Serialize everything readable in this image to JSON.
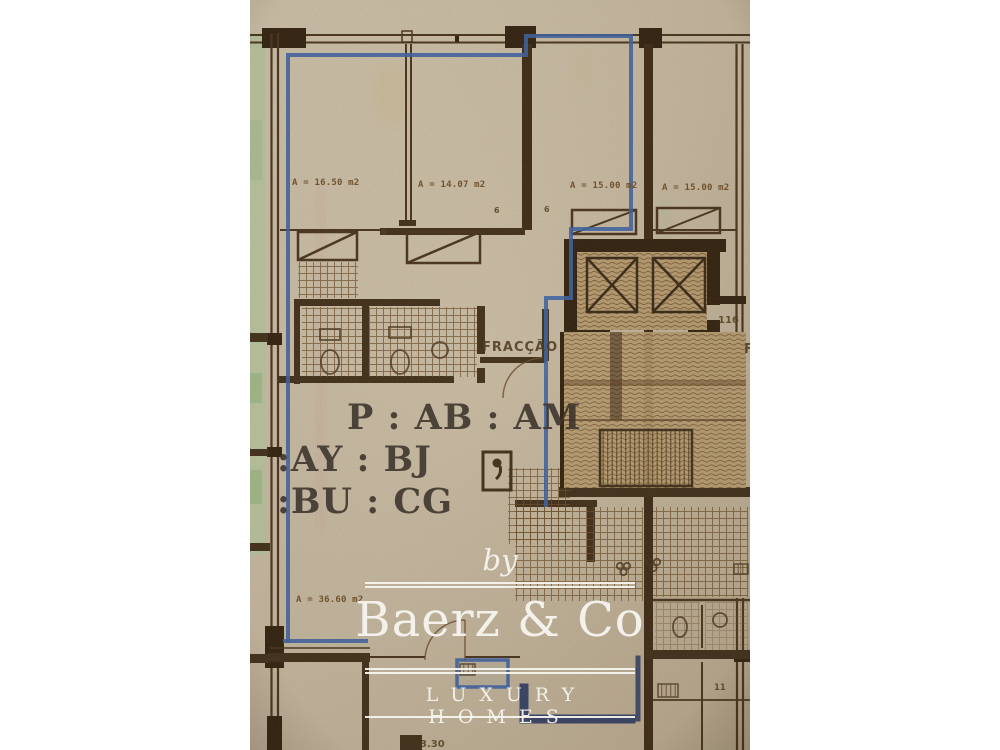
{
  "plan": {
    "area_labels": [
      "A = 16.50 m2",
      "A = 14.07 m2",
      "A = 15.00 m2",
      "A = 15.00 m2",
      "A = 36.60 m2"
    ],
    "fraccao_label": "FRACÇÃO",
    "unit_code": {
      "line1": "P : AB : AM",
      "line2": ":AY : BJ",
      "line3": ":BU : CG"
    },
    "stair_number": "116",
    "room_number": "11",
    "dimension_label": "3.30",
    "door_width_labels": [
      "6",
      "6",
      "6"
    ]
  },
  "watermark": {
    "prefix": "by",
    "brand": "Baerz & Co",
    "tagline": "LUXURY HOMES"
  },
  "colors": {
    "paper": "#c8bba1",
    "wall_brown": "#4a341d",
    "accent_blue": "#3e62a2",
    "navy": "#2c3a63",
    "highlight_green": "#b7c79f",
    "watermark_white": "#f6f4ee"
  }
}
